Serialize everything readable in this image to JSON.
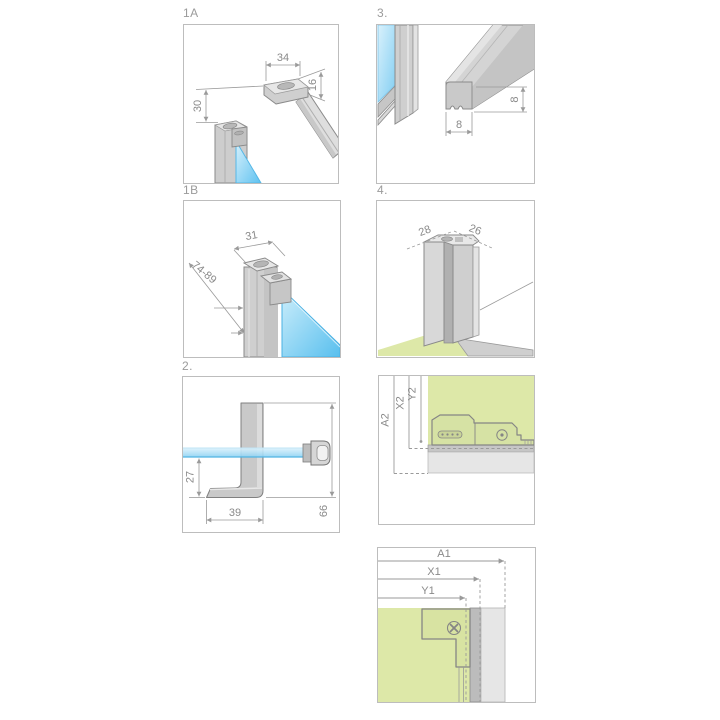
{
  "figure": {
    "type": "shower-enclosure-installation-diagram",
    "panels": {
      "p1a": {
        "label": "1A",
        "dim_width": "34",
        "dim_height": "16",
        "dim_offset": "30"
      },
      "p3": {
        "label": "3.",
        "dim_base": "8",
        "dim_side": "8"
      },
      "p1b": {
        "label": "1B",
        "dim_width": "31",
        "dim_range": "74-89"
      },
      "p4": {
        "label": "4.",
        "dim_left": "28",
        "dim_right": "26"
      },
      "p2": {
        "label": "2.",
        "dim_drop": "27",
        "dim_foot": "39",
        "dim_total": "66"
      },
      "pa2": {
        "dim_a": "A2",
        "dim_x": "X2",
        "dim_y": "Y2"
      },
      "pa1": {
        "dim_a": "A1",
        "dim_x": "X1",
        "dim_y": "Y1"
      }
    },
    "colors": {
      "glass": "#7fcdf2",
      "floor_green": "#dde8a8",
      "metal_light": "#e6e6e6",
      "metal": "#d2d2d2",
      "outline": "#8a8a8a",
      "dim": "#9a9a9a",
      "panel_border": "#bdbdbd"
    }
  }
}
